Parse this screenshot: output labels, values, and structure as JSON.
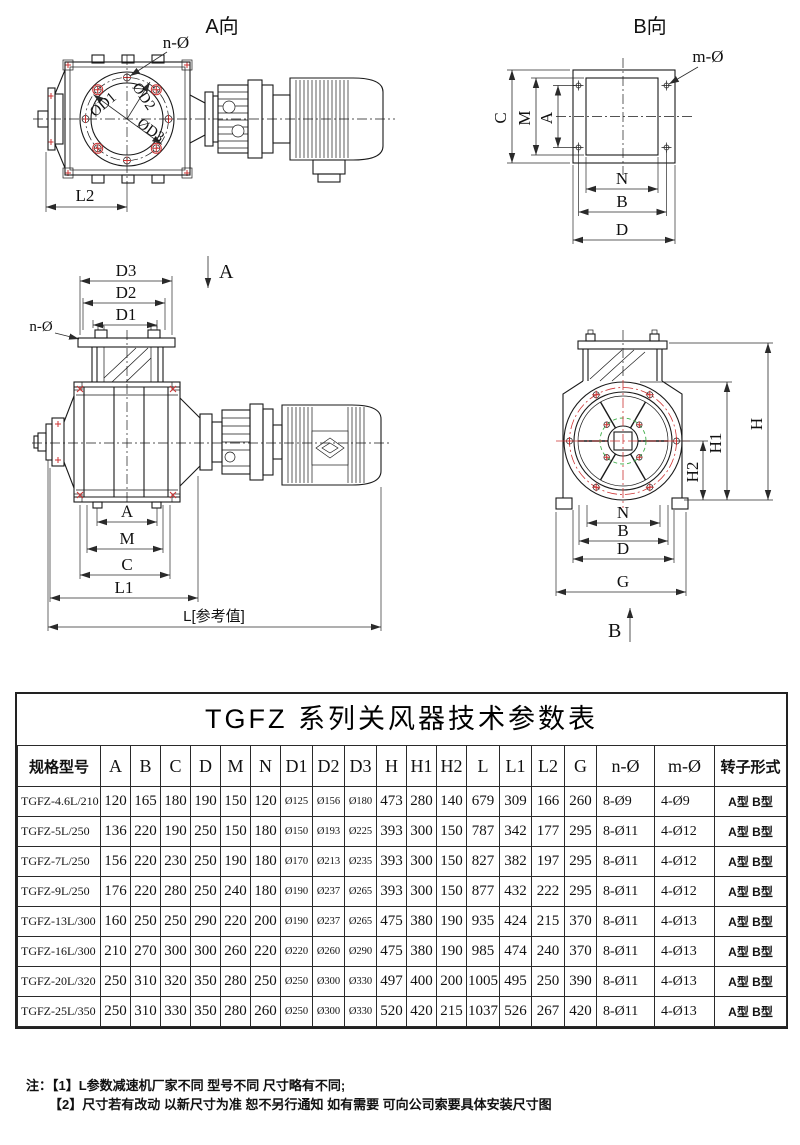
{
  "drawings": {
    "view_a": {
      "title": "A向",
      "n_label": "n-Ø",
      "d1": "ØD1",
      "d2": "ØD2",
      "d3": "ØD3",
      "l2": "L2"
    },
    "view_b": {
      "title": "B向",
      "m_label": "m-Ø",
      "c": "C",
      "m": "M",
      "a": "A",
      "n": "N",
      "b": "B",
      "d": "D"
    },
    "front": {
      "d3": "D3",
      "d2": "D2",
      "d1": "D1",
      "n_label": "n-Ø",
      "section": "A",
      "a": "A",
      "m": "M",
      "c": "C",
      "l1": "L1",
      "l_ref": "L[参考值]"
    },
    "end": {
      "h": "H",
      "h1": "H1",
      "h2": "H2",
      "n": "N",
      "b": "B",
      "d": "D",
      "g": "G",
      "section": "B"
    },
    "colors": {
      "line": "#1a1a1a",
      "accent_red": "#cc3333",
      "accent_green": "#3fae49"
    }
  },
  "table": {
    "title": "TGFZ 系列关风器技术参数表",
    "headers": [
      "规格型号",
      "A",
      "B",
      "C",
      "D",
      "M",
      "N",
      "D1",
      "D2",
      "D3",
      "H",
      "H1",
      "H2",
      "L",
      "L1",
      "L2",
      "G",
      "n-Ø",
      "m-Ø",
      "转子形式"
    ],
    "rows": [
      [
        "TGFZ-4.6L/210",
        "120",
        "165",
        "180",
        "190",
        "150",
        "120",
        "Ø125",
        "Ø156",
        "Ø180",
        "473",
        "280",
        "140",
        "679",
        "309",
        "166",
        "260",
        "8-Ø9",
        "4-Ø9",
        "A型 B型"
      ],
      [
        "TGFZ-5L/250",
        "136",
        "220",
        "190",
        "250",
        "150",
        "180",
        "Ø150",
        "Ø193",
        "Ø225",
        "393",
        "300",
        "150",
        "787",
        "342",
        "177",
        "295",
        "8-Ø11",
        "4-Ø12",
        "A型 B型"
      ],
      [
        "TGFZ-7L/250",
        "156",
        "220",
        "230",
        "250",
        "190",
        "180",
        "Ø170",
        "Ø213",
        "Ø235",
        "393",
        "300",
        "150",
        "827",
        "382",
        "197",
        "295",
        "8-Ø11",
        "4-Ø12",
        "A型 B型"
      ],
      [
        "TGFZ-9L/250",
        "176",
        "220",
        "280",
        "250",
        "240",
        "180",
        "Ø190",
        "Ø237",
        "Ø265",
        "393",
        "300",
        "150",
        "877",
        "432",
        "222",
        "295",
        "8-Ø11",
        "4-Ø12",
        "A型 B型"
      ],
      [
        "TGFZ-13L/300",
        "160",
        "250",
        "250",
        "290",
        "220",
        "200",
        "Ø190",
        "Ø237",
        "Ø265",
        "475",
        "380",
        "190",
        "935",
        "424",
        "215",
        "370",
        "8-Ø11",
        "4-Ø13",
        "A型 B型"
      ],
      [
        "TGFZ-16L/300",
        "210",
        "270",
        "300",
        "300",
        "260",
        "220",
        "Ø220",
        "Ø260",
        "Ø290",
        "475",
        "380",
        "190",
        "985",
        "474",
        "240",
        "370",
        "8-Ø11",
        "4-Ø13",
        "A型 B型"
      ],
      [
        "TGFZ-20L/320",
        "250",
        "310",
        "320",
        "350",
        "280",
        "250",
        "Ø250",
        "Ø300",
        "Ø330",
        "497",
        "400",
        "200",
        "1005",
        "495",
        "250",
        "390",
        "8-Ø11",
        "4-Ø13",
        "A型 B型"
      ],
      [
        "TGFZ-25L/350",
        "250",
        "310",
        "330",
        "350",
        "280",
        "260",
        "Ø250",
        "Ø300",
        "Ø330",
        "520",
        "420",
        "215",
        "1037",
        "526",
        "267",
        "420",
        "8-Ø11",
        "4-Ø13",
        "A型 B型"
      ]
    ]
  },
  "notes": {
    "prefix": "注：",
    "line1": "【1】L参数减速机厂家不同 型号不同 尺寸略有不同;",
    "line2": "【2】尺寸若有改动 以新尺寸为准 恕不另行通知 如有需要 可向公司索要具体安装尺寸图"
  }
}
